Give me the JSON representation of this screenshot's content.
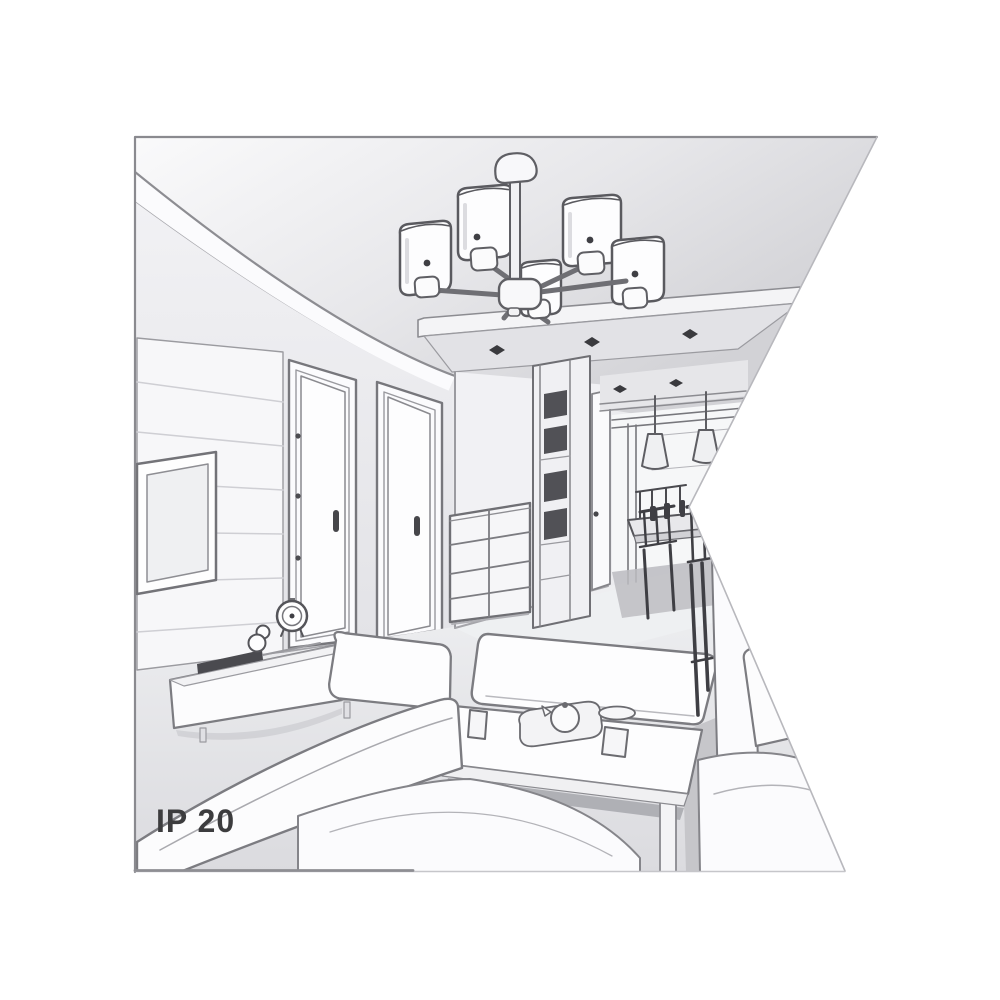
{
  "page": {
    "background": "#ffffff"
  },
  "artwork": {
    "kind": "interior-room-line-drawing",
    "description": "Grayscale perspective sketch of a living room: multi-arm ceiling chandelier with cylindrical shades, dropped ceiling with recessed spotlights, paneled TV wall, two interior doors, hallway with drawer chest and wardrobe, dining nook with cone pendant lights, table and chairs, white sofas, ottoman and coffee table with tea set. A white wedge notch cuts into the right edge of the picture.",
    "ip_rating_label": "IP 20",
    "palette": {
      "background": "#ffffff",
      "frame_border": "#8a8a8f",
      "outline": "#6f6f74",
      "outline_dark": "#3f3f44",
      "outline_light": "#b5b5ba",
      "surface_white": "#fdfdfe",
      "wall_light": "#f2f2f4",
      "wall_mid": "#e4e4e8",
      "ceiling_shade": "#d5d5d9",
      "floor_shadow": "#c6c6ca"
    },
    "objects": [
      "frame-border",
      "notch-cutout",
      "ceiling",
      "cove-molding",
      "ceiling-slab",
      "recessed-spotlights",
      "chandelier",
      "chandelier-canopy",
      "chandelier-stem",
      "chandelier-hub",
      "chandelier-arms",
      "lamp-shades",
      "tv-panel-wall",
      "tv-screen",
      "interior-door-1",
      "interior-door-2",
      "door-handles",
      "door-hinges",
      "hallway",
      "drawer-chest",
      "wardrobe",
      "hallway-door",
      "dining-ceiling",
      "pendant-lights",
      "window-wall",
      "dining-table",
      "dining-chairs",
      "tv-console",
      "soundbar",
      "alarm-clock",
      "figurine",
      "sofa-left",
      "sofa-armrest",
      "sofa-seat",
      "ottoman",
      "coffee-table",
      "cup",
      "teapot-tray",
      "plate",
      "side-panel",
      "side-cushion",
      "chaise",
      "floor"
    ]
  }
}
